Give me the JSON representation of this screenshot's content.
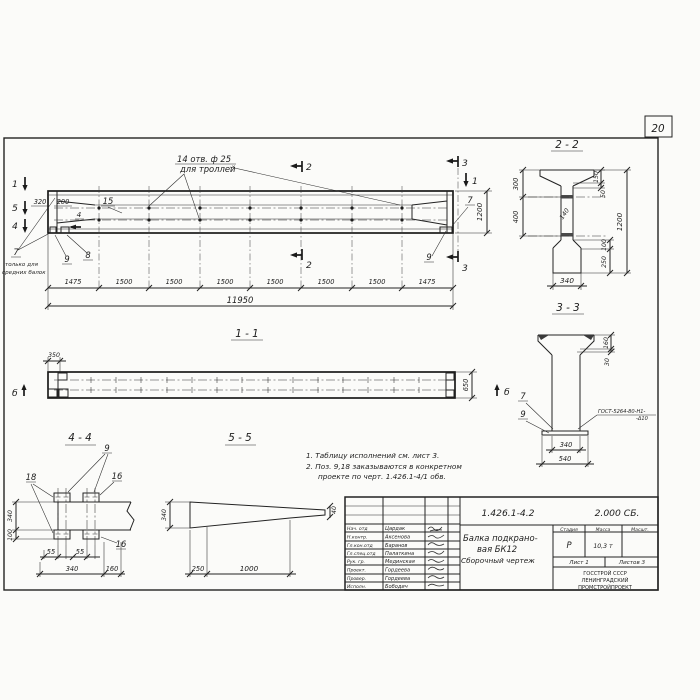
{
  "page": {
    "sheet_number": "20"
  },
  "elevation": {
    "hole_note_line1": "14 отв. ф 25",
    "hole_note_line2": "для троллей",
    "dim_320": "320",
    "dim_200": "200",
    "pos_15": "15",
    "pos_4_flag": "4",
    "marker_1_left": "1",
    "marker_5_left": "5",
    "marker_4_left": "4",
    "marker_1_right": "1",
    "marker_2_top": "2",
    "marker_2_bottom": "2",
    "marker_3_top": "3",
    "marker_3_bottom": "3",
    "pos_7_right": "7",
    "pos_9_right": "9",
    "pos_7_left": "7",
    "pos_9_left": "9",
    "pos_8_left": "8",
    "note_left_line1": "только для",
    "note_left_line2": "средних балок",
    "dim_height": "1200",
    "dims_bottom": [
      "1475",
      "1500",
      "1500",
      "1500",
      "1500",
      "1500",
      "1500",
      "1475"
    ],
    "dim_total": "11950"
  },
  "section22": {
    "title": "2 - 2",
    "dim_300": "300",
    "dim_400": "400",
    "dim_150": "150",
    "dim_50": "50",
    "dim_1200": "1200",
    "dim_140": "140",
    "dim_100": "100",
    "dim_250": "250",
    "dim_340": "340"
  },
  "section33": {
    "title": "3 - 3",
    "dim_160": "160",
    "dim_30": "30",
    "pos_7": "7",
    "pos_9": "9",
    "weld_line1": "ГОСТ-5264-80-Н1-",
    "weld_line2": "-Δ10",
    "dim_340": "340",
    "dim_540": "540",
    "marker_b": "б"
  },
  "section11": {
    "title": "1 - 1",
    "dim_350": "350",
    "dim_650": "650",
    "marker_b_left": "б",
    "marker_b_right": "б"
  },
  "section44": {
    "title": "4 - 4",
    "pos_9": "9",
    "pos_18": "18",
    "pos_16_top": "16",
    "pos_16_bottom": "16",
    "dim_340_left": "340",
    "dim_100": "100",
    "dim_55_a": "55",
    "dim_55_b": "55",
    "dim_340_bottom": "340",
    "dim_160": "160"
  },
  "section55": {
    "title": "5 - 5",
    "dim_340": "340",
    "dim_40": "40",
    "dim_250": "250",
    "dim_1000": "1000"
  },
  "notes": {
    "line1": "1. Таблицу исполнений см. лист 3.",
    "line2": "2. Поз. 9,18 заказываются в конкретном",
    "line3": "проекте по черт. 1.426.1-4/1 обв."
  },
  "stamp": {
    "doc_number": "1.426.1-4.2",
    "doc_code": "2.000 СБ.",
    "title_line1": "Балка подкрано-",
    "title_line2": "вая БК12",
    "title_line3": "Сборочный чертеж",
    "col_stage": "Стадия",
    "col_mass": "Масса",
    "col_scale": "Масшт.",
    "stage": "Р",
    "mass": "10,3 т",
    "sheet": "Лист 1",
    "sheets": "Листов 3",
    "org_line1": "ГОССТРОЙ СССР",
    "org_line2": "ЛЕНИНГРАДСКИЙ",
    "org_line3": "ПРОМСТРОЙПРОЕКТ",
    "signatures": [
      {
        "role": "Нач. отд",
        "name": "Цардак"
      },
      {
        "role": "Н.контр.",
        "name": "Аксенова"
      },
      {
        "role": "Гл.кон.отд",
        "name": "Баранов"
      },
      {
        "role": "Гл.спец.отд",
        "name": "Палаткина"
      },
      {
        "role": "Рук. гр.",
        "name": "Мединская"
      },
      {
        "role": "Проект.",
        "name": "Гордеева"
      },
      {
        "role": "Провер.",
        "name": "Гордеева"
      },
      {
        "role": "Исполн.",
        "name": "Бободич"
      }
    ]
  }
}
